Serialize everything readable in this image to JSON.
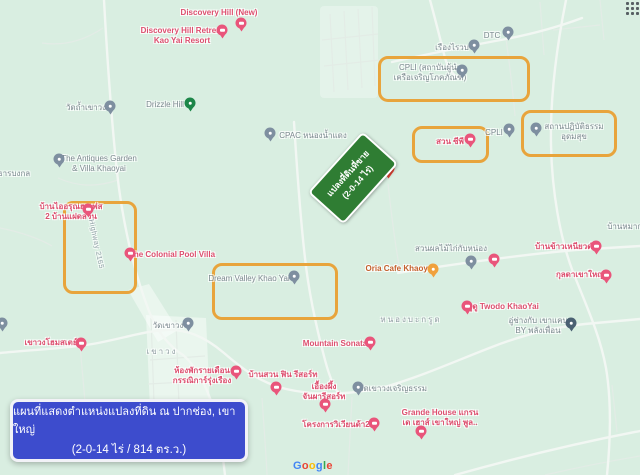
{
  "map": {
    "colors": {
      "bg": "#d9eee1",
      "label_pink": "#dd4e6e",
      "label_gray": "#7c898f",
      "label_area": "#93a0a5",
      "label_cafe": "#c4602c",
      "pin_pink": "#e9557b",
      "pin_gray": "#7e8fa0",
      "pin_dark": "#4a6072",
      "pin_green": "#1d8649",
      "pin_red": "#e94335",
      "pin_orange": "#f0a03c",
      "highlight": "#e8a43c",
      "sign_green": "#2f7d33",
      "caption_bg": "#3d4ccd"
    },
    "places": [
      {
        "name": "discovery-hill-new",
        "lines": [
          "Discovery Hill (New)"
        ],
        "x": 219,
        "y": 8,
        "type": "pink",
        "marker": {
          "cx": 241,
          "cy": 23,
          "color": "pink"
        }
      },
      {
        "name": "discovery-hill-retreat",
        "lines": [
          "Discovery Hill Retreat",
          "Kao Yai Resort"
        ],
        "x": 182,
        "y": 26,
        "type": "pink",
        "marker": {
          "cx": 222,
          "cy": 30,
          "color": "pink"
        }
      },
      {
        "name": "wat-tham-khao-wong",
        "lines": [
          "วัดถ้ำเขาวง"
        ],
        "x": 86,
        "y": 103,
        "type": "gray",
        "marker": {
          "cx": 110,
          "cy": 106,
          "color": "gray"
        }
      },
      {
        "name": "drizzle-hill",
        "lines": [
          "Drizzle Hill"
        ],
        "x": 165,
        "y": 100,
        "type": "gray",
        "marker": {
          "cx": 190,
          "cy": 103,
          "color": "green"
        }
      },
      {
        "name": "cpac-nong-nam-daeng",
        "lines": [
          "CPAC หนองน้ำแดง"
        ],
        "x": 313,
        "y": 131,
        "type": "gray",
        "marker": {
          "cx": 270,
          "cy": 133,
          "color": "gray"
        }
      },
      {
        "name": "dtc",
        "lines": [
          "DTC"
        ],
        "x": 492,
        "y": 31,
        "type": "gray",
        "marker": {
          "cx": 508,
          "cy": 32,
          "color": "gray"
        }
      },
      {
        "name": "rueang-rai",
        "lines": [
          "เรืองไรวบ"
        ],
        "x": 452,
        "y": 43,
        "type": "gray",
        "marker": {
          "cx": 474,
          "cy": 45,
          "color": "gray"
        }
      },
      {
        "name": "cpli-institute",
        "lines": [
          "CPLI (สถาบันผู้นำ",
          "เครือเจริญโภคภัณฑ์)"
        ],
        "x": 430,
        "y": 63,
        "type": "gray",
        "marker": {
          "cx": 462,
          "cy": 70,
          "color": "gray"
        }
      },
      {
        "name": "cpli",
        "lines": [
          "CPLI"
        ],
        "x": 494,
        "y": 128,
        "type": "gray",
        "marker": {
          "cx": 509,
          "cy": 129,
          "color": "gray"
        }
      },
      {
        "name": "meditation-center-udomsuk",
        "lines": [
          "สถานปฏิบัติธรรม",
          "อุดมสุข"
        ],
        "x": 574,
        "y": 122,
        "type": "gray",
        "marker": {
          "cx": 536,
          "cy": 128,
          "color": "gray"
        }
      },
      {
        "name": "antiques-garden-villa",
        "lines": [
          "The Antiques Garden",
          "& Villa Khaoyai"
        ],
        "x": 99,
        "y": 154,
        "type": "gray",
        "marker": {
          "cx": 59,
          "cy": 159,
          "color": "gray"
        }
      },
      {
        "name": "than-bong-kol",
        "lines": [
          "ธารบงกล"
        ],
        "x": 14,
        "y": 169,
        "type": "gray"
      },
      {
        "name": "ban-ai-arun",
        "lines": [
          "บ้านไออรุณฮาเฟส",
          "2 บ้านแฝดสวน"
        ],
        "x": 71,
        "y": 202,
        "type": "pink",
        "marker": {
          "cx": 88,
          "cy": 209,
          "color": "pink"
        }
      },
      {
        "name": "colonial-pool-villa",
        "lines": [
          "The Colonial Pool Villa"
        ],
        "x": 172,
        "y": 250,
        "type": "pink",
        "marker": {
          "cx": 130,
          "cy": 253,
          "color": "pink"
        }
      },
      {
        "name": "suan-cp",
        "lines": [
          "สวน ซีพี"
        ],
        "x": 450,
        "y": 137,
        "type": "pink",
        "marker": {
          "cx": 470,
          "cy": 139,
          "color": "pink"
        }
      },
      {
        "name": "dream-valley-khao-yai",
        "lines": [
          "Dream Valley Khao Yai"
        ],
        "x": 249,
        "y": 274,
        "type": "gray",
        "marker": {
          "cx": 294,
          "cy": 276,
          "color": "gray"
        }
      },
      {
        "name": "oria-cafe-khaoyai",
        "lines": [
          "Oria Cafe Khaoyai"
        ],
        "x": 400,
        "y": 264,
        "type": "cafe",
        "marker": {
          "cx": 433,
          "cy": 269,
          "color": "orange"
        }
      },
      {
        "name": "fruit-orchard",
        "lines": [
          "สวนผลไม้ไก่กับหน่อง"
        ],
        "x": 451,
        "y": 244,
        "type": "gray",
        "marker": {
          "cx": 471,
          "cy": 261,
          "color": "gray"
        }
      },
      {
        "name": "ban-mak",
        "lines": [
          "บ้านหมาก.."
        ],
        "x": 627,
        "y": 222,
        "type": "gray"
      },
      {
        "name": "ban-khao-niao-dam",
        "lines": [
          "บ้านข้าวเหนียวดำ"
        ],
        "x": 566,
        "y": 242,
        "type": "pink",
        "marker": {
          "cx": 596,
          "cy": 246,
          "color": "pink"
        }
      },
      {
        "name": "kunlada-khaoyai",
        "lines": [
          "กุลดาเขาใหญ่"
        ],
        "x": 580,
        "y": 270,
        "type": "pink",
        "marker": {
          "cx": 606,
          "cy": 275,
          "color": "pink"
        }
      },
      {
        "name": "twodo-khaoyai",
        "lines": [
          "ทูดู Twodo KhaoYai"
        ],
        "x": 503,
        "y": 302,
        "type": "pink",
        "marker": {
          "cx": 467,
          "cy": 306,
          "color": "pink"
        }
      },
      {
        "name": "garage-khao-khaep",
        "lines": [
          "อู่ช่างกับ เขาแคบ",
          "BY พลังเพื่อน"
        ],
        "x": 538,
        "y": 316,
        "type": "gray",
        "marker": {
          "cx": 571,
          "cy": 323,
          "color": "dark"
        }
      },
      {
        "name": "mountain-sonata",
        "lines": [
          "Mountain Sonata"
        ],
        "x": 335,
        "y": 339,
        "type": "pink",
        "marker": {
          "cx": 370,
          "cy": 342,
          "color": "pink"
        }
      },
      {
        "name": "khao-wong-homestay",
        "lines": [
          "เขาวงโฮมสเตย์"
        ],
        "x": 51,
        "y": 338,
        "type": "pink",
        "marker": {
          "cx": 81,
          "cy": 343,
          "color": "pink"
        }
      },
      {
        "name": "wat-khao-wong",
        "lines": [
          "วัดเขาวง"
        ],
        "x": 168,
        "y": 321,
        "type": "gray",
        "marker": {
          "cx": 188,
          "cy": 323,
          "color": "gray"
        }
      },
      {
        "name": "monthly-rooms-kannika",
        "lines": [
          "ห้องพักรายเดือน",
          "กรรณิการ์รุ่งเรือง"
        ],
        "x": 202,
        "y": 366,
        "type": "pink",
        "marker": {
          "cx": 236,
          "cy": 371,
          "color": "pink"
        }
      },
      {
        "name": "ban-suan-fin-resort",
        "lines": [
          "บ้านสวน ฟิน รีสอร์ท"
        ],
        "x": 283,
        "y": 370,
        "type": "pink",
        "marker": {
          "cx": 276,
          "cy": 387,
          "color": "pink"
        }
      },
      {
        "name": "ueang-phueng-chanpha-resort",
        "lines": [
          "เอื้องผึ้ง",
          "จันผารีสอร์ท"
        ],
        "x": 324,
        "y": 382,
        "type": "pink",
        "marker": {
          "cx": 325,
          "cy": 404,
          "color": "pink"
        }
      },
      {
        "name": "wat-khao-wong-charoen-tham",
        "lines": [
          "วัดเขาวงเจริญธรรม"
        ],
        "x": 393,
        "y": 384,
        "type": "gray",
        "marker": {
          "cx": 358,
          "cy": 387,
          "color": "gray"
        }
      },
      {
        "name": "viviente-2",
        "lines": [
          "โครงการวิเวียนด้า2"
        ],
        "x": 336,
        "y": 420,
        "type": "pink",
        "marker": {
          "cx": 374,
          "cy": 423,
          "color": "pink"
        }
      },
      {
        "name": "grande-house",
        "lines": [
          "Grande House แกรน",
          "เด เฮาส์ เขาใหญ่ พูล.."
        ],
        "x": 440,
        "y": 408,
        "type": "pink",
        "marker": {
          "cx": 421,
          "cy": 431,
          "color": "pink"
        }
      },
      {
        "name": "khao-wong-area",
        "lines": [
          "เขาวง"
        ],
        "x": 162,
        "y": 347,
        "type": "area"
      },
      {
        "name": "nong-ba-krut-area",
        "lines": [
          "หนองบะกรูด"
        ],
        "x": 411,
        "y": 315,
        "type": "area"
      },
      {
        "name": "highway-2165",
        "lines": [
          "Highway 2165"
        ],
        "x": 95,
        "y": 240,
        "type": "road",
        "rotate": 78
      }
    ],
    "extra_markers": [
      {
        "name": "lodging-pin-orchard",
        "cx": 494,
        "cy": 259,
        "color": "pink"
      },
      {
        "name": "edge-pin-left",
        "cx": 2,
        "cy": 323,
        "color": "gray"
      },
      {
        "name": "land-plot-pin",
        "cx": 388,
        "cy": 168,
        "color": "red"
      }
    ],
    "highlight_boxes": [
      {
        "name": "cpli-institute",
        "x": 378,
        "y": 56,
        "w": 146,
        "h": 40
      },
      {
        "name": "suan-cp",
        "x": 412,
        "y": 126,
        "w": 71,
        "h": 31
      },
      {
        "name": "meditation-center",
        "x": 521,
        "y": 110,
        "w": 90,
        "h": 41
      },
      {
        "name": "highway-plot",
        "x": 63,
        "y": 201,
        "w": 68,
        "h": 87
      },
      {
        "name": "dream-valley",
        "x": 212,
        "y": 263,
        "w": 120,
        "h": 51
      }
    ],
    "sign": {
      "line1": "แปลงที่ดินที่ขาย",
      "line2": "(2-0-14 ไร่)"
    },
    "caption": {
      "line1": "แผนที่แสดงตำแหน่งแปลงที่ดิน ณ ปากช่อง, เขาใหญ่",
      "line2": "(2-0-14 ไร่ / 814 ตร.ว.)"
    },
    "google_logo": {
      "text": "Google",
      "letter_colors": [
        "#4285F4",
        "#EA4335",
        "#FBBC05",
        "#4285F4",
        "#34A853",
        "#EA4335"
      ]
    }
  }
}
